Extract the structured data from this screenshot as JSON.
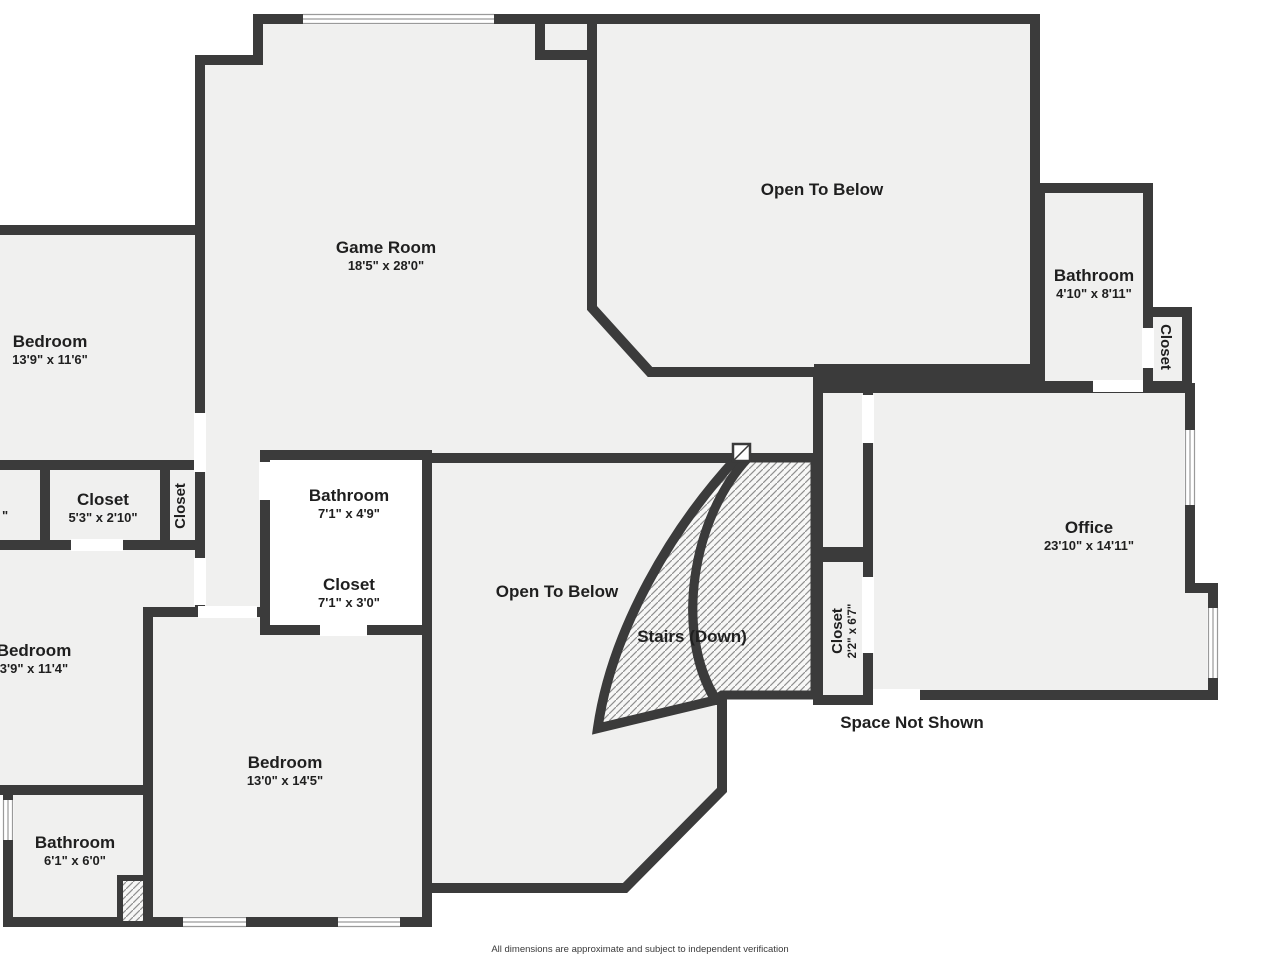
{
  "colors": {
    "wall": "#3b3b3b",
    "floor": "#f0f0ef",
    "background": "#ffffff",
    "hatch_line": "#8f8f8f",
    "text": "#1f1f1f"
  },
  "rooms": {
    "game_room": {
      "label": "Game Room",
      "dims": "18'5\" x 28'0\""
    },
    "open_to_below_top": {
      "label": "Open To Below"
    },
    "bathroom_right": {
      "label": "Bathroom",
      "dims": "4'10\" x 8'11\""
    },
    "closet_right_edge": {
      "label": "Closet"
    },
    "bedroom_top_left": {
      "label": "Bedroom",
      "dims": "13'9\" x 11'6\""
    },
    "closet_left": {
      "label": "Closet",
      "dims": "5'3\" x 2'10\""
    },
    "closet_left_vertical": {
      "label": "Closet"
    },
    "cut_dimension_fragment": {
      "label": "\""
    },
    "bathroom_center": {
      "label": "Bathroom",
      "dims": "7'1\" x 4'9\""
    },
    "closet_center": {
      "label": "Closet",
      "dims": "7'1\" x 3'0\""
    },
    "open_to_below_center": {
      "label": "Open To Below"
    },
    "stairs": {
      "label": "Stairs (Down)"
    },
    "closet_stairs": {
      "label": "Closet",
      "dims": "2'2\" x 6'7\""
    },
    "office": {
      "label": "Office",
      "dims": "23'10\" x 14'11\""
    },
    "space_not_shown": {
      "label": "Space Not Shown"
    },
    "bedroom_mid_left": {
      "label": "Bedroom",
      "dims": "3'9\" x 11'4\""
    },
    "bedroom_bottom": {
      "label": "Bedroom",
      "dims": "13'0\" x 14'5\""
    },
    "bathroom_bottom_left": {
      "label": "Bathroom",
      "dims": "6'1\" x 6'0\""
    }
  },
  "footer": {
    "disclaimer": "All dimensions are approximate and subject to independent verification"
  }
}
